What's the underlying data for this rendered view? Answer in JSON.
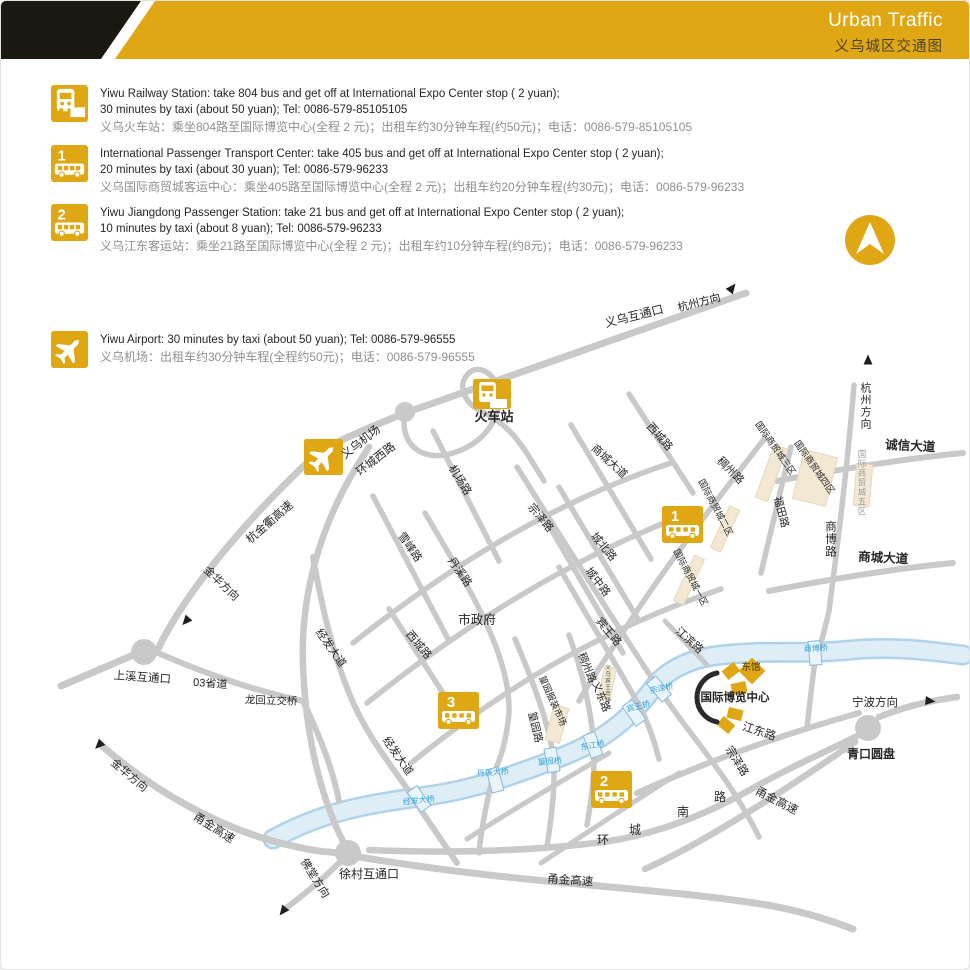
{
  "header": {
    "title_en": "Urban Traffic",
    "title_zh": "义乌城区交通图"
  },
  "colors": {
    "gold": "#DFA713",
    "road": "#C9C9C9",
    "river_fill": "#DEEDF6",
    "river_edge": "#AFD3EA",
    "beige": "#F3E8D4",
    "text_dark": "#262626",
    "text_gray": "#8f8f8f",
    "bridge_blue": "#2FA3DC",
    "header_black": "#1b1812"
  },
  "legend": {
    "blocks": [
      {
        "icon": "train",
        "badge": "",
        "lines_en": [
          "Yiwu Railway Station: take 804 bus and get off at International Expo Center stop ( 2 yuan);",
          "30 minutes by taxi (about 50 yuan); Tel: 0086-579-85105105"
        ],
        "line_zh": "义乌火车站：乘坐804路至国际博览中心(全程 2 元)；出租车约30分钟车程(约50元)；电话：0086-579-85105105"
      },
      {
        "icon": "bus",
        "badge": "1",
        "lines_en": [
          "International Passenger Transport Center: take 405 bus and get off at International Expo Center stop ( 2 yuan);",
          "20 minutes by taxi (about 30 yuan); Tel: 0086-579-96233"
        ],
        "line_zh": "义乌国际商贸城客运中心：乘坐405路至国际博览中心(全程 2 元)；出租车约20分钟车程(约30元)；电话：0086-579-96233"
      },
      {
        "icon": "bus",
        "badge": "2",
        "lines_en": [
          "Yiwu Jiangdong Passenger Station: take 21 bus and get off at International Expo Center stop ( 2 yuan);",
          "10 minutes by taxi (about 8 yuan); Tel: 0086-579-96233"
        ],
        "line_zh": "义乌江东客运站：乘坐21路至国际博览中心(全程 2 元)；出租车约10分钟车程(约8元)；电话：0086-579-96233"
      },
      {
        "icon": "plane",
        "badge": "",
        "lines_en": [
          "Yiwu Airport: 30 minutes by taxi (about 50 yuan); Tel: 0086-579-96555"
        ],
        "line_zh": "义乌机场：出租车约30分钟车程(全程约50元)；电话：0086-579-96555"
      }
    ]
  },
  "map": {
    "labels": [
      {
        "t": "义乌互通口",
        "x": 634,
        "y": 319,
        "r": -14,
        "s": 12
      },
      {
        "t": "杭州方向",
        "x": 699,
        "y": 305,
        "r": -14,
        "s": 11
      },
      {
        "t": "火车站",
        "x": 493,
        "y": 420,
        "s": 13,
        "b": 1
      },
      {
        "t": "义乌机场",
        "x": 362,
        "y": 444,
        "r": -38,
        "s": 11.5
      },
      {
        "t": "环城西路",
        "x": 377,
        "y": 461,
        "r": -38,
        "s": 11.5
      },
      {
        "t": "杭金衢高速",
        "x": 271,
        "y": 524,
        "r": -41,
        "s": 11.5
      },
      {
        "t": "金华方向",
        "x": 218,
        "y": 585,
        "r": 44,
        "s": 11
      },
      {
        "t": "上溪互通口",
        "x": 141,
        "y": 680,
        "r": 4,
        "s": 11.5
      },
      {
        "t": "03省道",
        "x": 209,
        "y": 686,
        "r": 4,
        "s": 11
      },
      {
        "t": "龙回立交桥",
        "x": 270,
        "y": 703,
        "r": 2,
        "s": 10.5
      },
      {
        "t": "经发大道",
        "x": 327,
        "y": 649,
        "r": 55,
        "s": 11
      },
      {
        "t": "经发大道",
        "x": 394,
        "y": 757,
        "r": 55,
        "s": 11
      },
      {
        "t": "机场路",
        "x": 456,
        "y": 481,
        "r": 58,
        "s": 11
      },
      {
        "t": "雪峰路",
        "x": 406,
        "y": 548,
        "r": 55,
        "s": 11
      },
      {
        "t": "丹溪路",
        "x": 456,
        "y": 573,
        "r": 55,
        "s": 11
      },
      {
        "t": "西城路",
        "x": 656,
        "y": 438,
        "r": 48,
        "s": 11
      },
      {
        "t": "西城路",
        "x": 415,
        "y": 646,
        "r": 50,
        "s": 11
      },
      {
        "t": "商城大道",
        "x": 606,
        "y": 463,
        "r": 42,
        "s": 11
      },
      {
        "t": "城北路",
        "x": 600,
        "y": 548,
        "r": 50,
        "s": 11
      },
      {
        "t": "城中路",
        "x": 594,
        "y": 583,
        "r": 52,
        "s": 11
      },
      {
        "t": "宾王路",
        "x": 605,
        "y": 633,
        "r": 50,
        "s": 11
      },
      {
        "t": "市政府",
        "x": 476,
        "y": 623,
        "s": 12.5
      },
      {
        "t": "宗泽路",
        "x": 537,
        "y": 519,
        "r": 50,
        "s": 11
      },
      {
        "t": "宗泽路",
        "x": 733,
        "y": 762,
        "r": 58,
        "s": 11
      },
      {
        "t": "稠州路",
        "x": 727,
        "y": 472,
        "r": 45,
        "s": 11
      },
      {
        "t": "稠州路",
        "x": 583,
        "y": 668,
        "r": 68,
        "s": 10.5
      },
      {
        "t": "义东路",
        "x": 597,
        "y": 697,
        "r": 68,
        "s": 10.5
      },
      {
        "t": "篁园路",
        "x": 531,
        "y": 727,
        "r": 76,
        "s": 10.5
      },
      {
        "t": "江滨路",
        "x": 686,
        "y": 642,
        "r": 42,
        "s": 11
      },
      {
        "t": "福田路",
        "x": 777,
        "y": 512,
        "r": 75,
        "s": 10.5
      },
      {
        "t": "商博路",
        "x": 829,
        "y": 538,
        "v": 1,
        "s": 11.5
      },
      {
        "t": "杭州方向",
        "x": 864,
        "y": 405,
        "v": 1,
        "s": 11
      },
      {
        "t": "诚信大道",
        "x": 909,
        "y": 449,
        "r": 3,
        "s": 12.5,
        "b": 1
      },
      {
        "t": "商城大道",
        "x": 882,
        "y": 561,
        "r": 3,
        "s": 12.5,
        "b": 1
      },
      {
        "t": "国际商贸城一区",
        "x": 687,
        "y": 578,
        "r": 62,
        "s": 9
      },
      {
        "t": "国际商贸城二区",
        "x": 712,
        "y": 508,
        "r": 62,
        "s": 9
      },
      {
        "t": "国际商贸城三区",
        "x": 772,
        "y": 449,
        "r": 55,
        "s": 9
      },
      {
        "t": "国际商贸城四区",
        "x": 811,
        "y": 468,
        "r": 55,
        "s": 9
      },
      {
        "t": "国际商贸城五区",
        "x": 861,
        "y": 482,
        "v": 1,
        "s": 8.5,
        "c": "#9A9A9A"
      },
      {
        "t": "篁园服装市场",
        "x": 549,
        "y": 701,
        "r": 66,
        "s": 9
      },
      {
        "t": "义乌宾王市场",
        "x": 606,
        "y": 683,
        "v": 1,
        "s": 5.5,
        "c": "#4a4a4a"
      },
      {
        "t": "国际博览中心",
        "x": 734,
        "y": 700,
        "s": 11.5,
        "b": 1
      },
      {
        "t": "东馆",
        "x": 750,
        "y": 669,
        "s": 9.5,
        "c": "#423500"
      },
      {
        "t": "江东路",
        "x": 757,
        "y": 734,
        "r": 18,
        "s": 11.5
      },
      {
        "t": "宁波方向",
        "x": 874,
        "y": 705,
        "s": 11.5
      },
      {
        "t": "青口圆盘",
        "x": 870,
        "y": 757,
        "s": 12,
        "b": 1
      },
      {
        "t": "徐村互通口",
        "x": 368,
        "y": 877,
        "s": 12
      },
      {
        "t": "佛堂方向",
        "x": 311,
        "y": 879,
        "r": 58,
        "s": 11
      },
      {
        "t": "金华方向",
        "x": 126,
        "y": 777,
        "r": 40,
        "s": 11
      },
      {
        "t": "甬金高速",
        "x": 211,
        "y": 830,
        "r": 32,
        "s": 11.5
      },
      {
        "t": "甬金高速",
        "x": 569,
        "y": 883,
        "r": 4,
        "s": 11.5
      },
      {
        "t": "甬金高速",
        "x": 774,
        "y": 803,
        "r": 27,
        "s": 11.5
      },
      {
        "t": "环",
        "x": 602,
        "y": 843,
        "s": 12
      },
      {
        "t": "城",
        "x": 634,
        "y": 833,
        "s": 12
      },
      {
        "t": "南",
        "x": 682,
        "y": 815,
        "s": 12
      },
      {
        "t": "路",
        "x": 719,
        "y": 800,
        "s": 12
      },
      {
        "t": "宗泽桥",
        "x": 661,
        "y": 690,
        "r": -12,
        "s": 8,
        "c": "#2FA3DC"
      },
      {
        "t": "宾王桥",
        "x": 638,
        "y": 708,
        "r": -14,
        "s": 8,
        "c": "#2FA3DC"
      },
      {
        "t": "东江桥",
        "x": 592,
        "y": 747,
        "r": -10,
        "s": 8,
        "c": "#2FA3DC"
      },
      {
        "t": "篁园桥",
        "x": 549,
        "y": 763,
        "r": -4,
        "s": 8,
        "c": "#2FA3DC"
      },
      {
        "t": "丹溪大桥",
        "x": 492,
        "y": 774,
        "r": -4,
        "s": 8,
        "c": "#2FA3DC"
      },
      {
        "t": "经发大桥",
        "x": 418,
        "y": 802,
        "r": -6,
        "s": 8,
        "c": "#2FA3DC"
      },
      {
        "t": "商博桥",
        "x": 815,
        "y": 650,
        "r": -3,
        "s": 8,
        "c": "#2FA3DC"
      }
    ],
    "markers": [
      {
        "type": "train",
        "x": 472,
        "y": 378,
        "w": 38,
        "h": 30
      },
      {
        "type": "plane",
        "x": 303,
        "y": 438,
        "w": 39,
        "h": 36
      },
      {
        "type": "bus",
        "n": "1",
        "x": 661,
        "y": 505,
        "w": 41,
        "h": 37
      },
      {
        "type": "bus",
        "n": "3",
        "x": 437,
        "y": 691,
        "w": 41,
        "h": 37
      },
      {
        "type": "bus",
        "n": "2",
        "x": 590,
        "y": 770,
        "w": 41,
        "h": 37
      }
    ],
    "arrows": [
      {
        "x": 731,
        "y": 287,
        "r": 38
      },
      {
        "x": 867,
        "y": 359,
        "r": 0
      },
      {
        "x": 185,
        "y": 620,
        "r": 222
      },
      {
        "x": 98,
        "y": 744,
        "r": 225
      },
      {
        "x": 282,
        "y": 910,
        "r": 218
      },
      {
        "x": 929,
        "y": 700,
        "r": 96
      }
    ],
    "compass": {
      "x": 869,
      "y": 239,
      "r": 25
    }
  }
}
